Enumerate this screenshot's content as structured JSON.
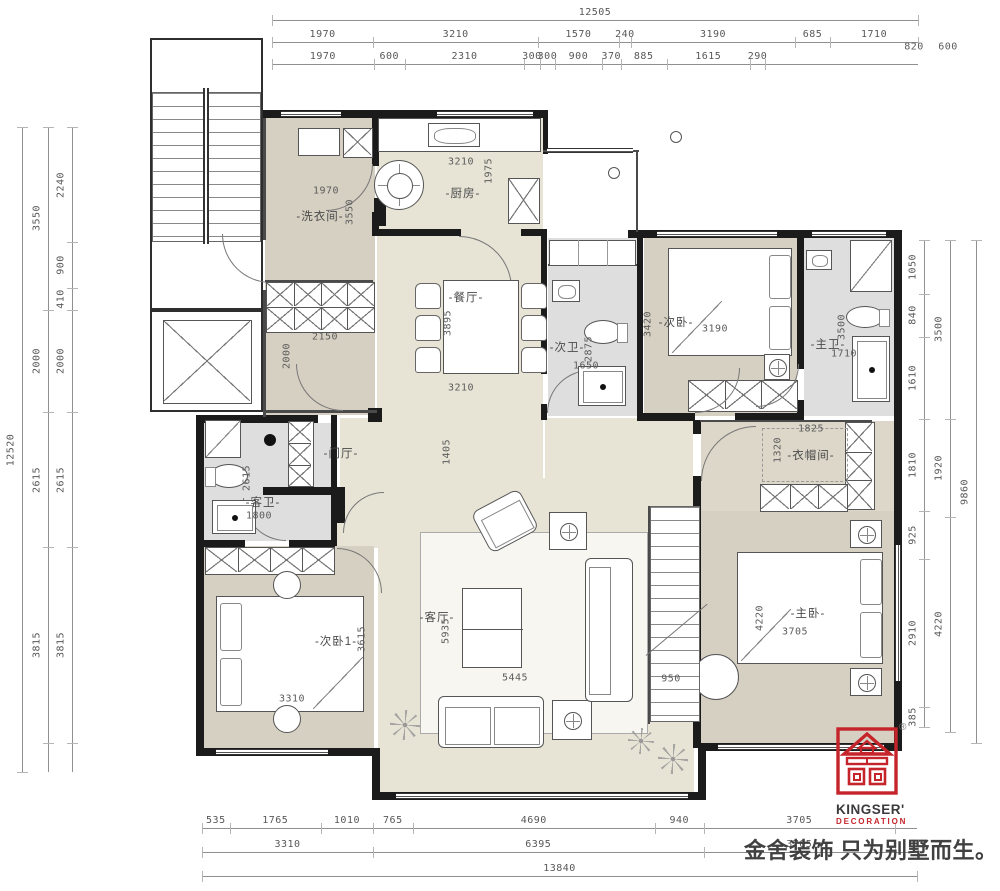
{
  "dimensions": {
    "top": {
      "total": [
        "12505"
      ],
      "row2": [
        "1970",
        "3210",
        "1570",
        "240",
        "3190",
        "685",
        "1710"
      ],
      "row2_extra": [
        "820",
        "600"
      ],
      "row3": [
        "1970",
        "600",
        "2310",
        "300",
        "300",
        "900",
        "370",
        "885",
        "1615",
        "290"
      ]
    },
    "left": {
      "total": [
        "12520"
      ],
      "col2": [
        "3550",
        "2000",
        "2615",
        "3815"
      ],
      "col3": [
        "2240",
        "900",
        "410",
        "2000",
        "2615",
        "3815"
      ]
    },
    "right": {
      "col1": [
        "1050",
        "840",
        "1610",
        "1810",
        "925",
        "2910",
        "385"
      ],
      "col2": [
        "3500",
        "1920",
        "4220"
      ],
      "total": [
        "9860"
      ]
    },
    "bottom": {
      "row1": [
        "535",
        "1765",
        "1010",
        "765",
        "4690",
        "940",
        "3705"
      ],
      "row2": [
        "3310",
        "6395",
        "3705"
      ],
      "total": [
        "13840"
      ]
    }
  },
  "plan_texts": [
    {
      "t": "-洗衣间-",
      "x": 320,
      "y": 216,
      "k": "room"
    },
    {
      "t": "-厨房-",
      "x": 463,
      "y": 193,
      "k": "room"
    },
    {
      "t": "-餐厅-",
      "x": 466,
      "y": 297,
      "k": "room"
    },
    {
      "t": "-次卫-",
      "x": 567,
      "y": 347,
      "k": "room"
    },
    {
      "t": "-次卧-",
      "x": 676,
      "y": 322,
      "k": "room"
    },
    {
      "t": "-主卫-",
      "x": 828,
      "y": 344,
      "k": "room"
    },
    {
      "t": "-门厅-",
      "x": 341,
      "y": 453,
      "k": "room"
    },
    {
      "t": "-客卫-",
      "x": 263,
      "y": 502,
      "k": "room"
    },
    {
      "t": "-衣帽间-",
      "x": 811,
      "y": 455,
      "k": "room"
    },
    {
      "t": "-次卧1-",
      "x": 336,
      "y": 641,
      "k": "room"
    },
    {
      "t": "-客厅-",
      "x": 437,
      "y": 617,
      "k": "room"
    },
    {
      "t": "-主卧-",
      "x": 808,
      "y": 613,
      "k": "room"
    },
    {
      "t": "1970",
      "x": 326,
      "y": 191,
      "k": "dim"
    },
    {
      "t": "3550",
      "x": 350,
      "y": 212,
      "k": "dim",
      "r": 1
    },
    {
      "t": "2150",
      "x": 325,
      "y": 337,
      "k": "dim"
    },
    {
      "t": "2000",
      "x": 287,
      "y": 356,
      "k": "dim",
      "r": 1
    },
    {
      "t": "3210",
      "x": 461,
      "y": 162,
      "k": "dim"
    },
    {
      "t": "1975",
      "x": 489,
      "y": 171,
      "k": "dim",
      "r": 1
    },
    {
      "t": "3895",
      "x": 448,
      "y": 323,
      "k": "dim",
      "r": 1
    },
    {
      "t": "3210",
      "x": 461,
      "y": 388,
      "k": "dim"
    },
    {
      "t": "2875",
      "x": 589,
      "y": 349,
      "k": "dim",
      "r": 1
    },
    {
      "t": "1650",
      "x": 586,
      "y": 366,
      "k": "dim"
    },
    {
      "t": "3420",
      "x": 648,
      "y": 324,
      "k": "dim",
      "r": 1
    },
    {
      "t": "3190",
      "x": 715,
      "y": 329,
      "k": "dim"
    },
    {
      "t": "3500",
      "x": 842,
      "y": 327,
      "k": "dim",
      "r": 1
    },
    {
      "t": "1710",
      "x": 844,
      "y": 354,
      "k": "dim"
    },
    {
      "t": "1405",
      "x": 447,
      "y": 452,
      "k": "dim",
      "r": 1
    },
    {
      "t": "2615",
      "x": 247,
      "y": 478,
      "k": "dim",
      "r": 1
    },
    {
      "t": "1800",
      "x": 259,
      "y": 516,
      "k": "dim"
    },
    {
      "t": "1825",
      "x": 811,
      "y": 429,
      "k": "dim"
    },
    {
      "t": "1320",
      "x": 778,
      "y": 450,
      "k": "dim",
      "r": 1
    },
    {
      "t": "3615",
      "x": 362,
      "y": 639,
      "k": "dim",
      "r": 1
    },
    {
      "t": "3310",
      "x": 292,
      "y": 699,
      "k": "dim"
    },
    {
      "t": "5935",
      "x": 446,
      "y": 631,
      "k": "dim",
      "r": 1
    },
    {
      "t": "5445",
      "x": 515,
      "y": 678,
      "k": "dim"
    },
    {
      "t": "950",
      "x": 671,
      "y": 679,
      "k": "dim"
    },
    {
      "t": "4220",
      "x": 760,
      "y": 618,
      "k": "dim",
      "r": 1
    },
    {
      "t": "3705",
      "x": 795,
      "y": 632,
      "k": "dim"
    },
    {
      "t": "820",
      "x": 914,
      "y": 47,
      "k": "dim"
    },
    {
      "t": "600",
      "x": 948,
      "y": 47,
      "k": "dim"
    }
  ],
  "logo": {
    "brand": "KINGSER'",
    "subtitle": "DECORATION",
    "registered": "®"
  },
  "slogan": "金舍装饰 只为别墅而生。",
  "colors": {
    "beige": "#e7e4d6",
    "taupe": "#d6d0c2",
    "gray": "#dedede",
    "cloak": "#ddd7ca",
    "wall": "#1b1b1b",
    "brand_red": "#c5242b",
    "dim_text": "#5c5c5c"
  }
}
